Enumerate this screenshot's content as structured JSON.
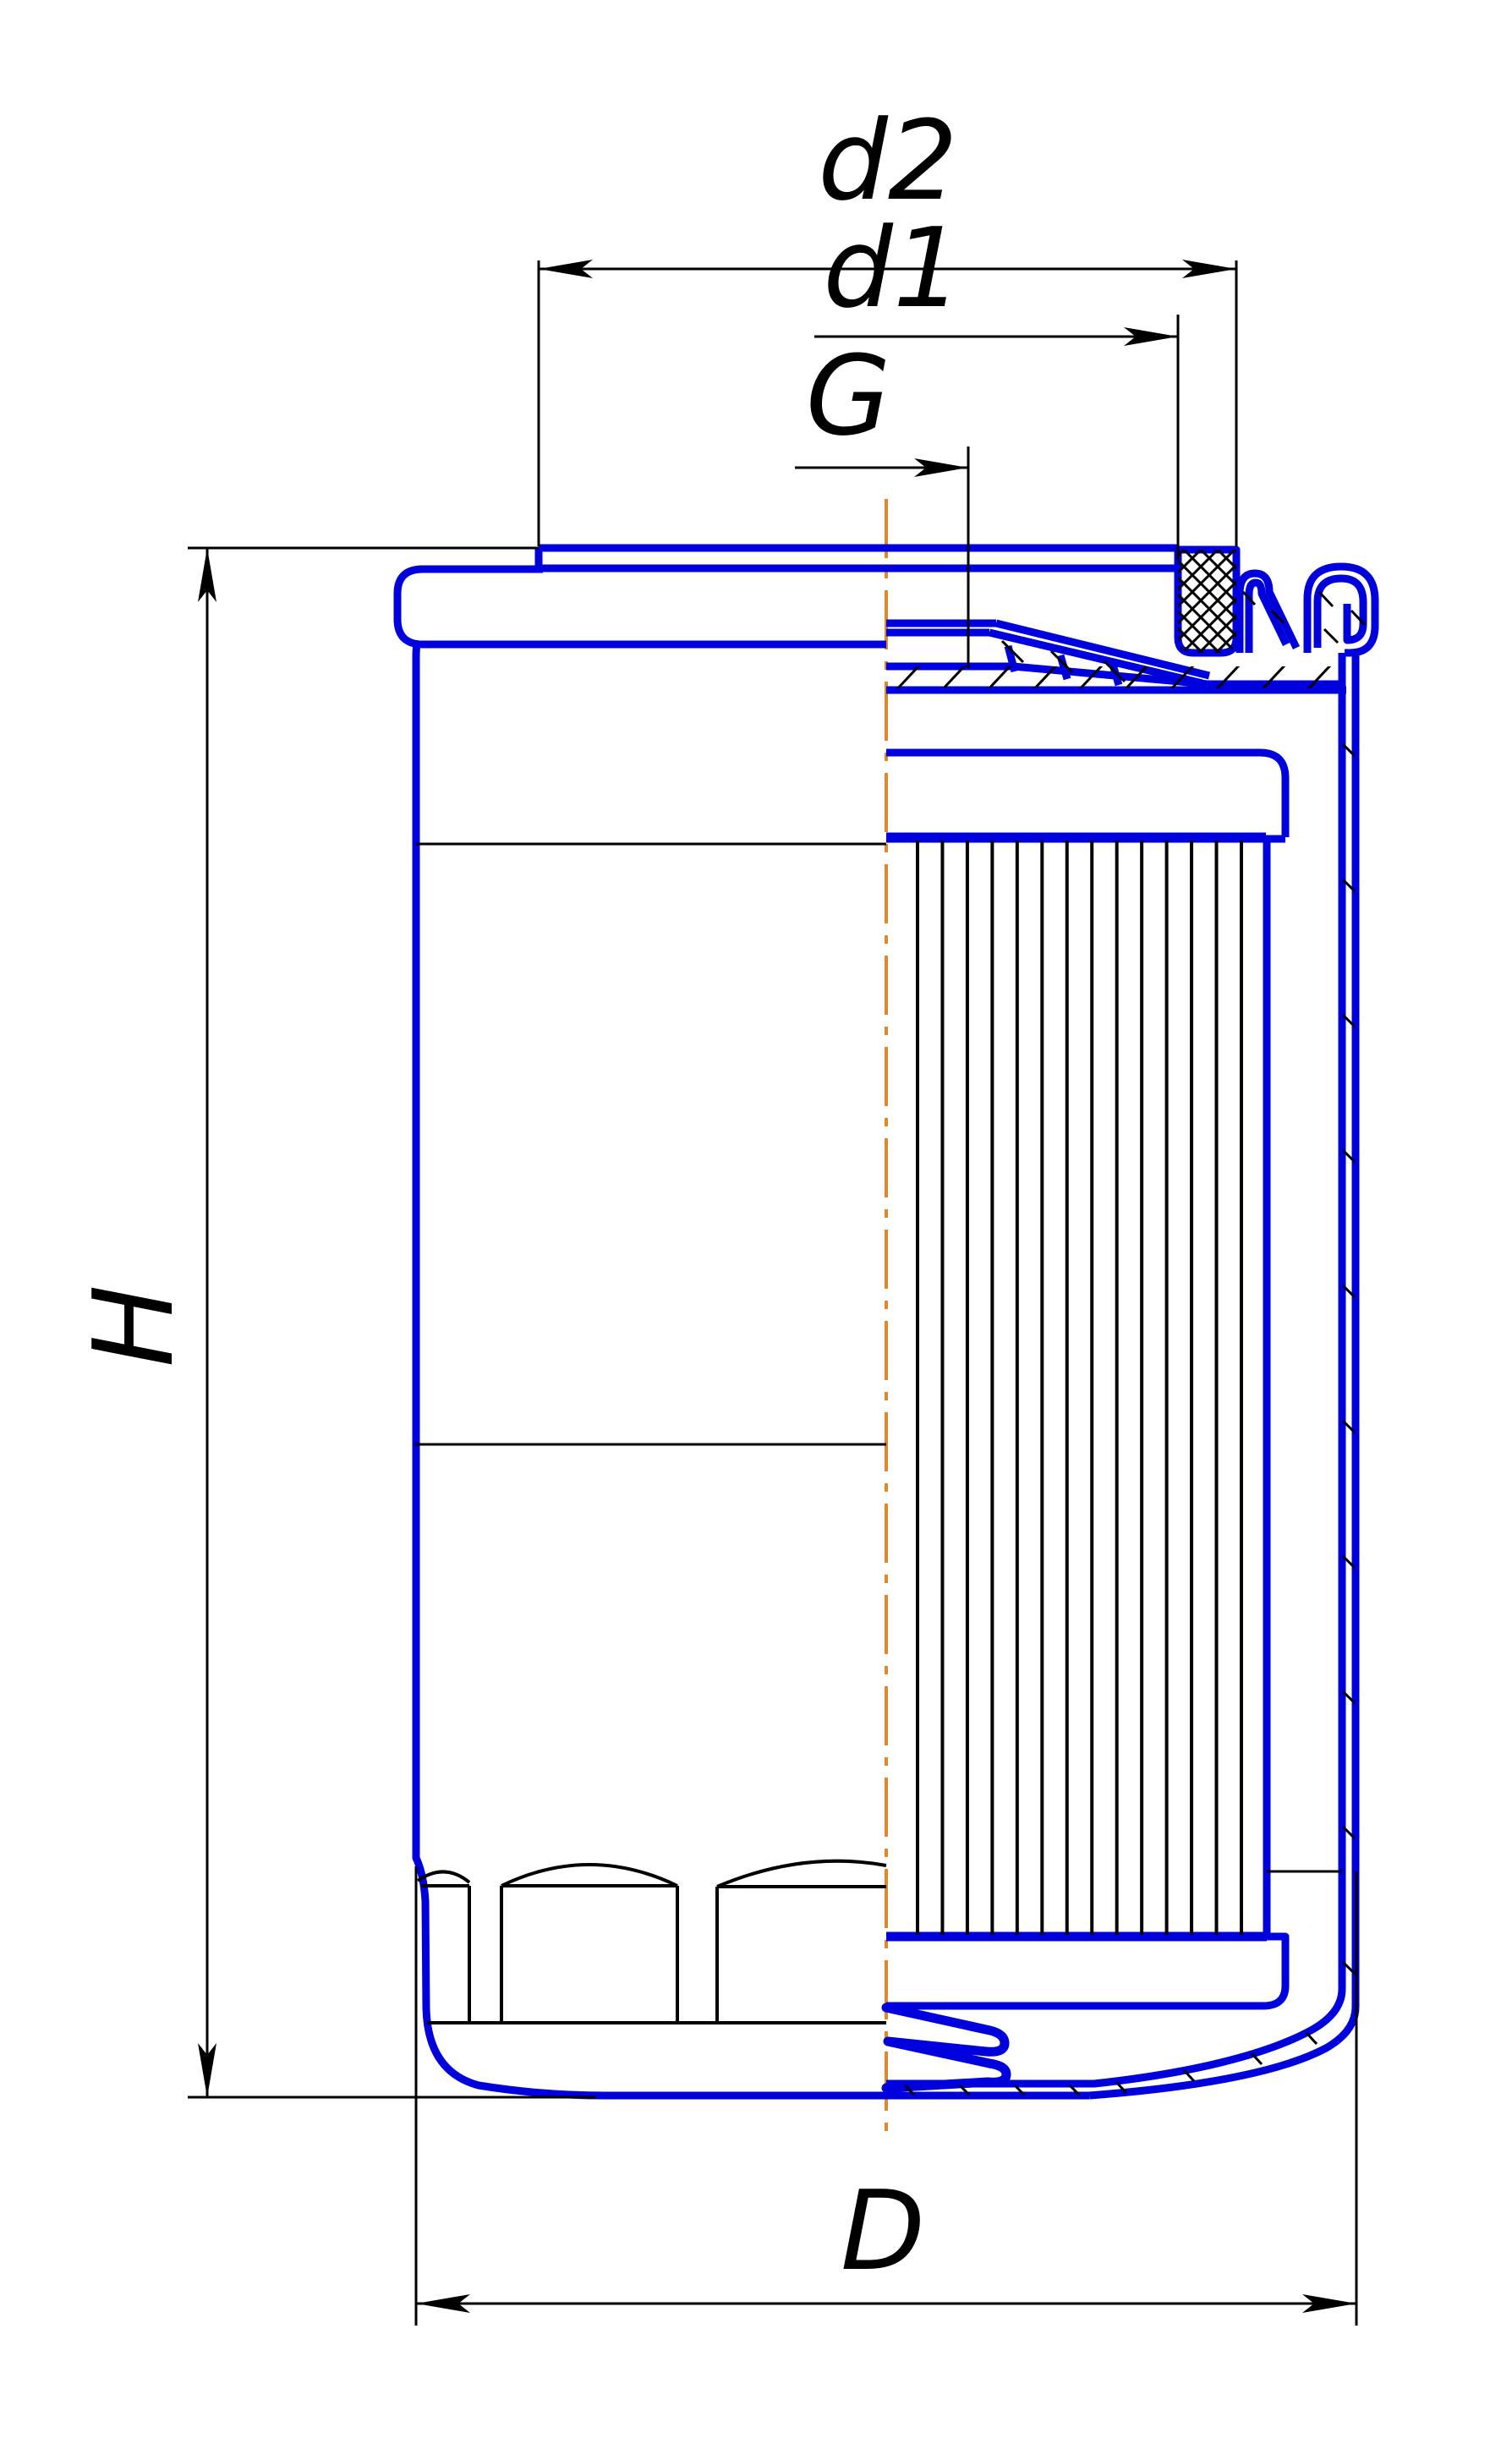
{
  "labels": {
    "d2": "d2",
    "d1": "d1",
    "G": "G",
    "H": "H",
    "D": "D"
  },
  "colors": {
    "line_blue": "#0000dd",
    "dimension_black": "#000000",
    "centerline_orange": "#dd8a2e",
    "background": "#ffffff"
  }
}
